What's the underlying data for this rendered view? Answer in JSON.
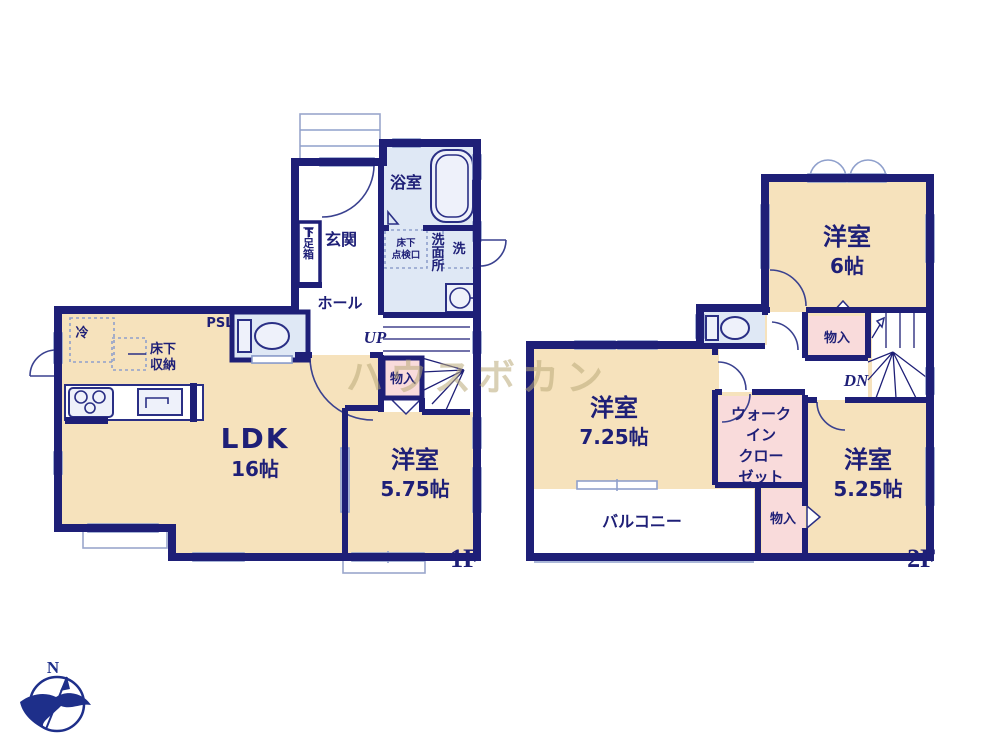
{
  "watermark": "ハウスボカン",
  "compass": {
    "north_label": "N"
  },
  "colors": {
    "wall_navy": "#1e1f77",
    "room_tan": "#f6e2bc",
    "closet_pink": "#f9dbdb",
    "wet_blue": "#dfe8f5",
    "fixture_gray_blue": "#8fa0cc",
    "watermark_tan": "rgba(186,170,120,0.55)"
  },
  "floor1": {
    "floor_label": "1F",
    "rooms": {
      "ldk": {
        "name": "LDK",
        "size": "16帖"
      },
      "bedroom": {
        "name": "洋室",
        "size": "5.75帖"
      },
      "entrance": "玄関",
      "hall": "ホール",
      "bath": "浴室",
      "washroom": "洗面所",
      "washer": "洗",
      "inspection_l1": "床下",
      "inspection_l2": "点検口",
      "shoe_t": "T",
      "shoe_box": "下足箱",
      "closet": "物入",
      "underfloor_l1": "床下",
      "underfloor_l2": "収納",
      "fridge": "冷",
      "pipe_space": "PSL",
      "stairs_up": "UP"
    }
  },
  "floor2": {
    "floor_label": "2F",
    "rooms": {
      "bedroom6": {
        "name": "洋室",
        "size": "6帖"
      },
      "bedroom725": {
        "name": "洋室",
        "size": "7.25帖"
      },
      "bedroom525": {
        "name": "洋室",
        "size": "5.25帖"
      },
      "wic_l1": "ウォーク",
      "wic_l2": "イン",
      "wic_l3": "クロー",
      "wic_l4": "ゼット",
      "closet_upper": "物入",
      "closet_lower": "物入",
      "balcony": "バルコニー",
      "stairs_down": "DN"
    }
  }
}
